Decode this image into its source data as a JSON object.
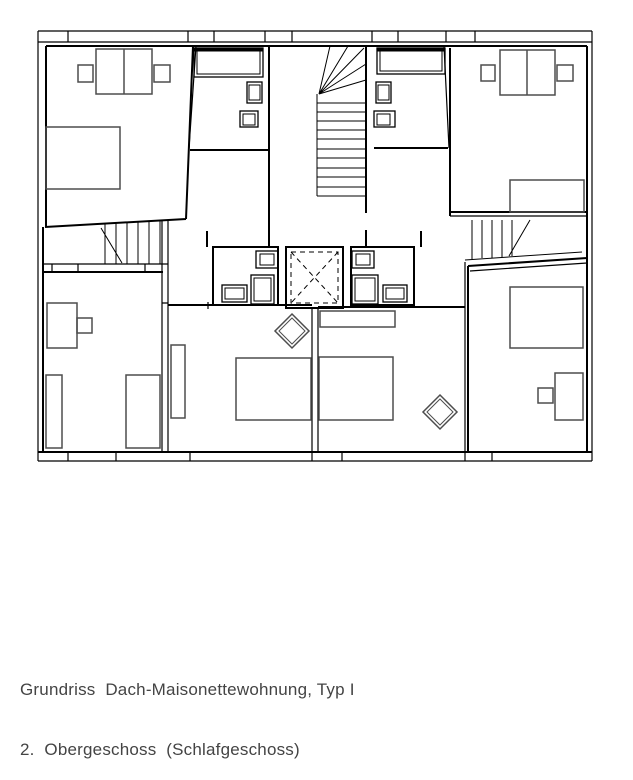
{
  "caption": {
    "line1": "Grundriss  Dach-Maisonettewohnung, Typ I",
    "line2": "2.  Obergeschoss  (Schlafgeschoss)"
  },
  "plan": {
    "drawing_type": "architectural floor plan",
    "colors": {
      "wall": "#000000",
      "furniture": "#4d4d4d",
      "caption": "#444444",
      "background": "#ffffff"
    }
  }
}
